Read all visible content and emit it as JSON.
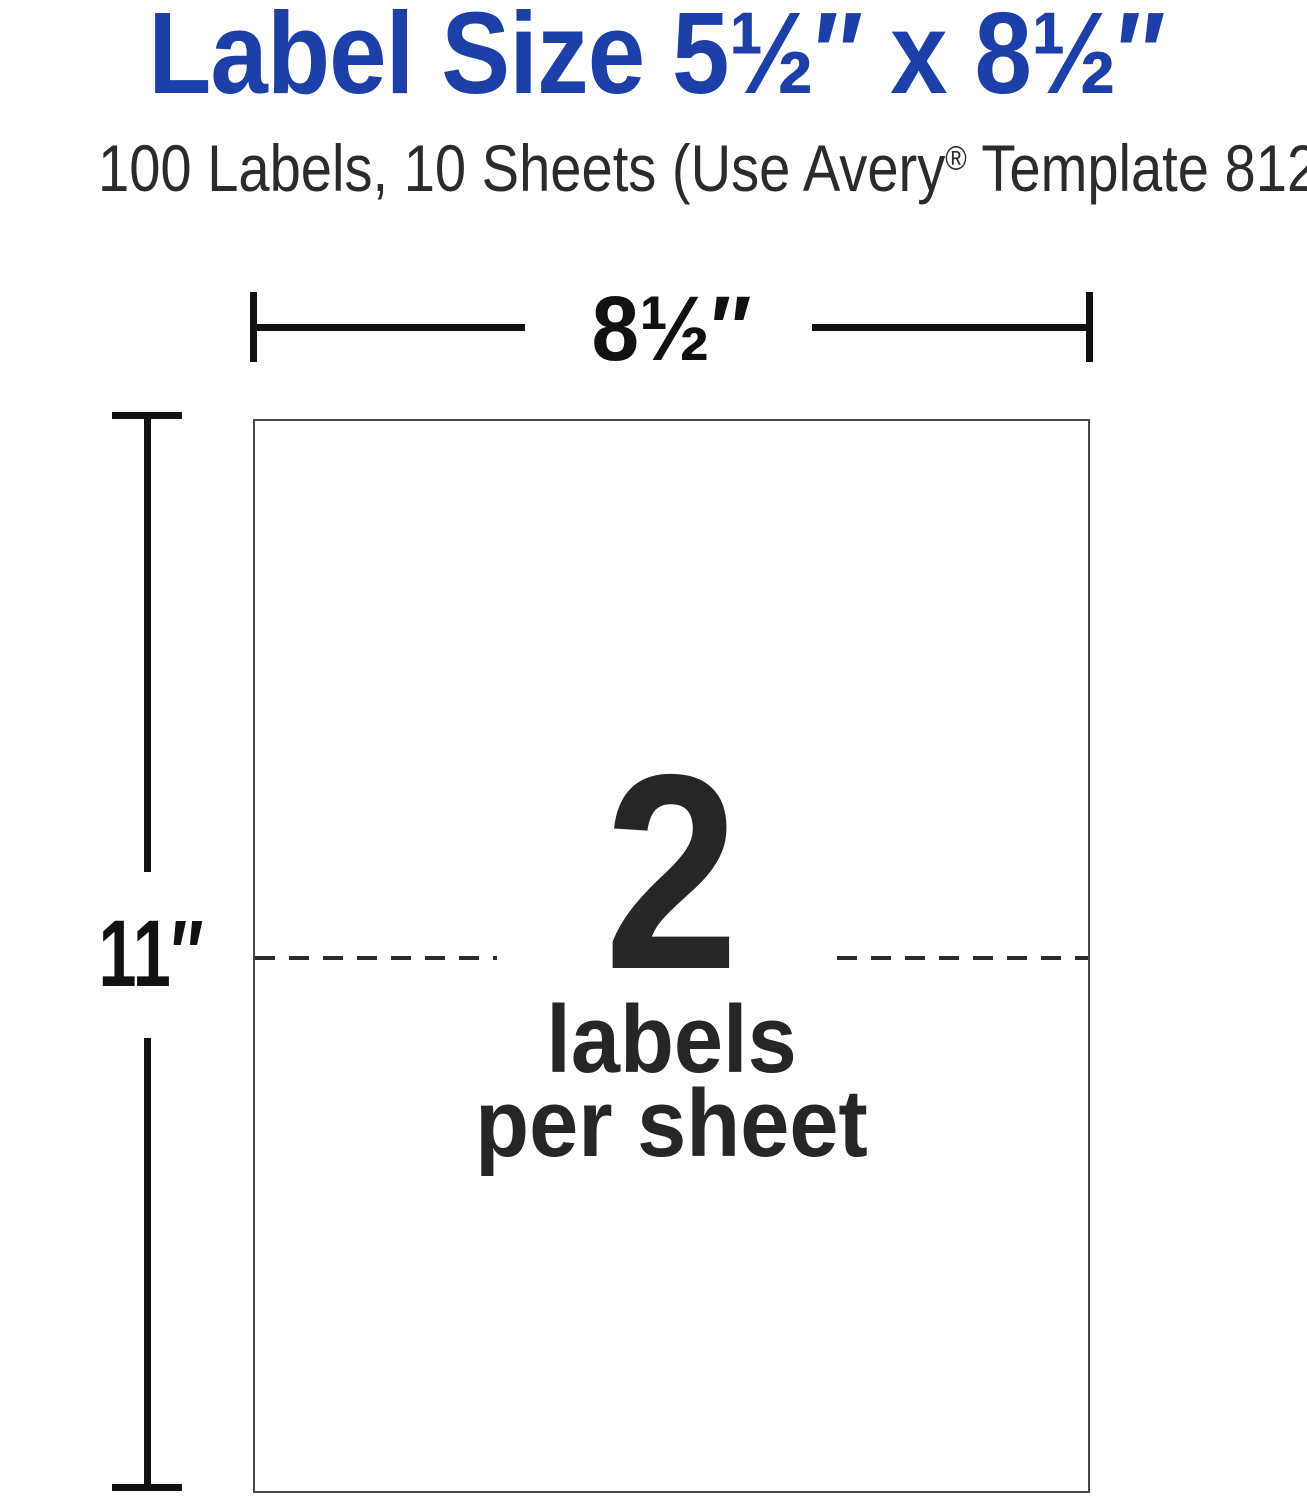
{
  "page": {
    "title": "Label Size 5½″ x 8½″",
    "subtitle": {
      "pre": "100 Labels, 10 Sheets (Use Avery",
      "reg_mark": "®",
      "post": " Template 8126)"
    }
  },
  "diagram": {
    "width_dimension": "8½″",
    "height_dimension": "11″",
    "labels_per_sheet_count": "2",
    "labels_per_sheet_line1": "labels",
    "labels_per_sheet_line2": "per sheet"
  },
  "colors": {
    "brand_blue": "#1c3fa8",
    "text_dark": "#2b2b2b",
    "line_black": "#111111",
    "sheet_border": "#484848"
  }
}
